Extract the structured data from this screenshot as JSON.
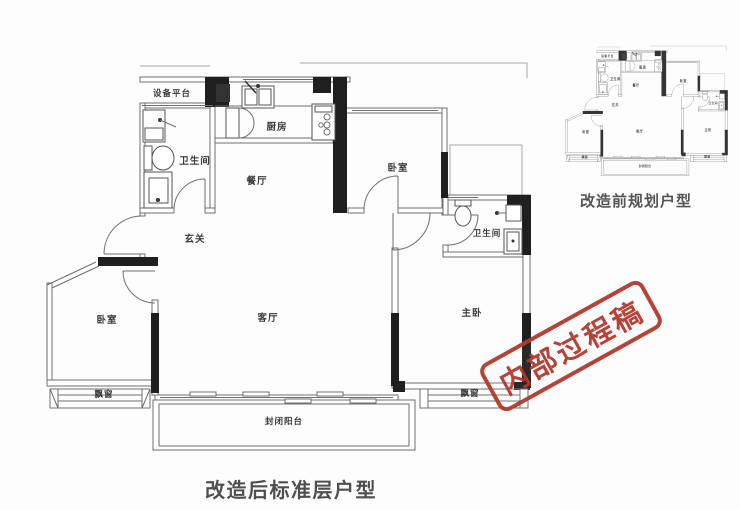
{
  "page": {
    "background": "#fdfdfd"
  },
  "colors": {
    "wall_black": "#1f1f1f",
    "wall_line": "#6f6f6f",
    "label_text": "#3a3a3a",
    "caption_text": "#4f4f4f",
    "stamp_red": "#b23a2e"
  },
  "main_plan": {
    "caption": "改造后标准层户型",
    "rooms": {
      "equipment_platform": "设备平台",
      "bathroom_top": "卫生间",
      "kitchen": "厨房",
      "dining": "餐厅",
      "bedroom_top": "卧室",
      "bathroom_right": "卫生间",
      "entry": "玄关",
      "bedroom_left": "卧室",
      "living": "客厅",
      "master": "主卧",
      "bay_left": "飘窗",
      "bay_right": "飘窗",
      "balcony": "封闭阳台"
    }
  },
  "mini_plan": {
    "caption": "改造前规划户型"
  },
  "stamp": {
    "text": "内部过程稿"
  }
}
